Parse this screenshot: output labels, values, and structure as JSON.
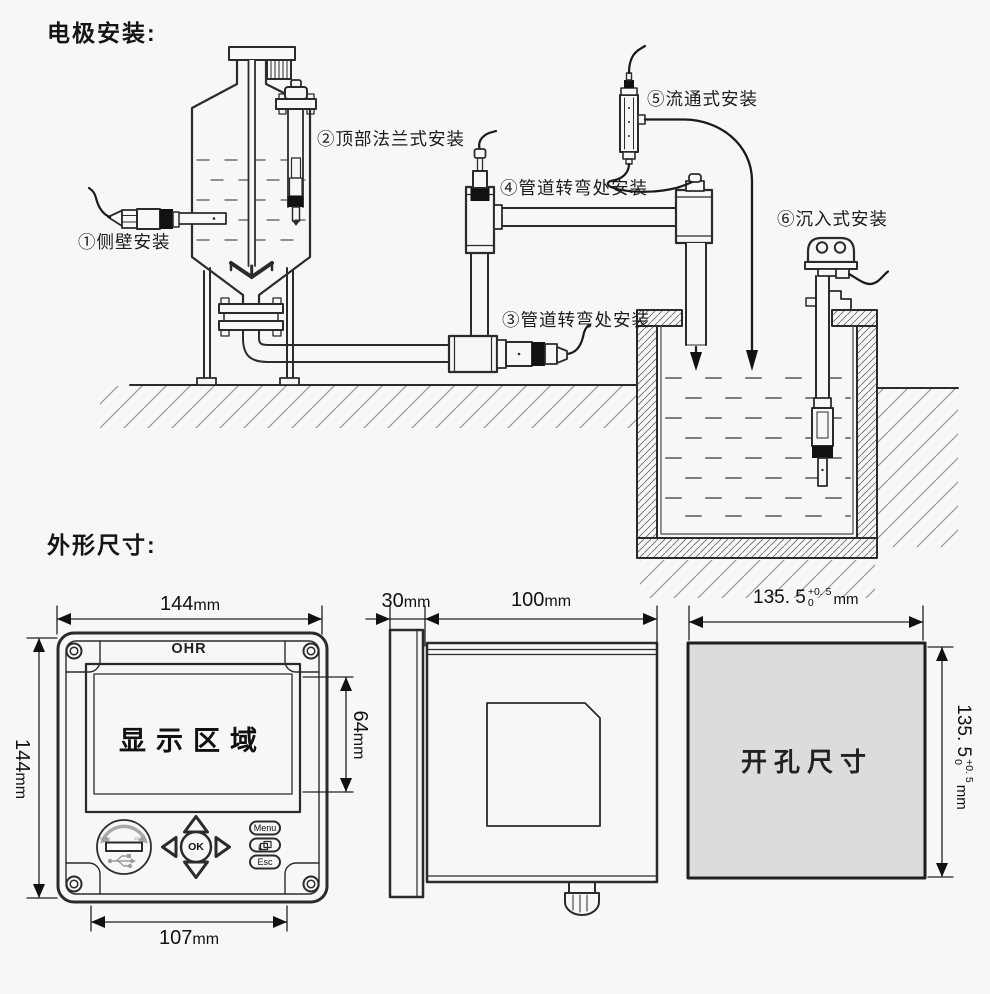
{
  "page": {
    "title_installation": "电极安装:",
    "title_dimensions": "外形尺寸:",
    "bg": "#f7f7f7",
    "ink": "#1f1f1f",
    "cutout_fill": "#dcdcdc"
  },
  "installation": {
    "labels": {
      "side_wall": "①侧壁安装",
      "top_flange": "②顶部法兰式安装",
      "pipe_bend_lower": "③管道转弯处安装",
      "pipe_bend_upper": "④管道转弯处安装",
      "flow_through": "⑤流通式安装",
      "submersion": "⑥沉入式安装"
    }
  },
  "front_view": {
    "brand": "OHR",
    "display_area": "显示区域",
    "width_value": "144",
    "height_value": "144",
    "display_height_value": "64",
    "mount_width_value": "107",
    "unit": "mm",
    "keys": {
      "ok": "OK",
      "menu": "Menu",
      "esc": "Esc"
    },
    "usb_open": "Open",
    "usb_close": "Close"
  },
  "side_view": {
    "bezel_depth_value": "30",
    "body_depth_value": "100",
    "unit": "mm"
  },
  "cutout_view": {
    "label": "开孔尺寸",
    "width_value": "135. 5",
    "height_value": "135. 5",
    "tol_upper": "+0. 5",
    "tol_lower": "0",
    "unit": "mm"
  }
}
